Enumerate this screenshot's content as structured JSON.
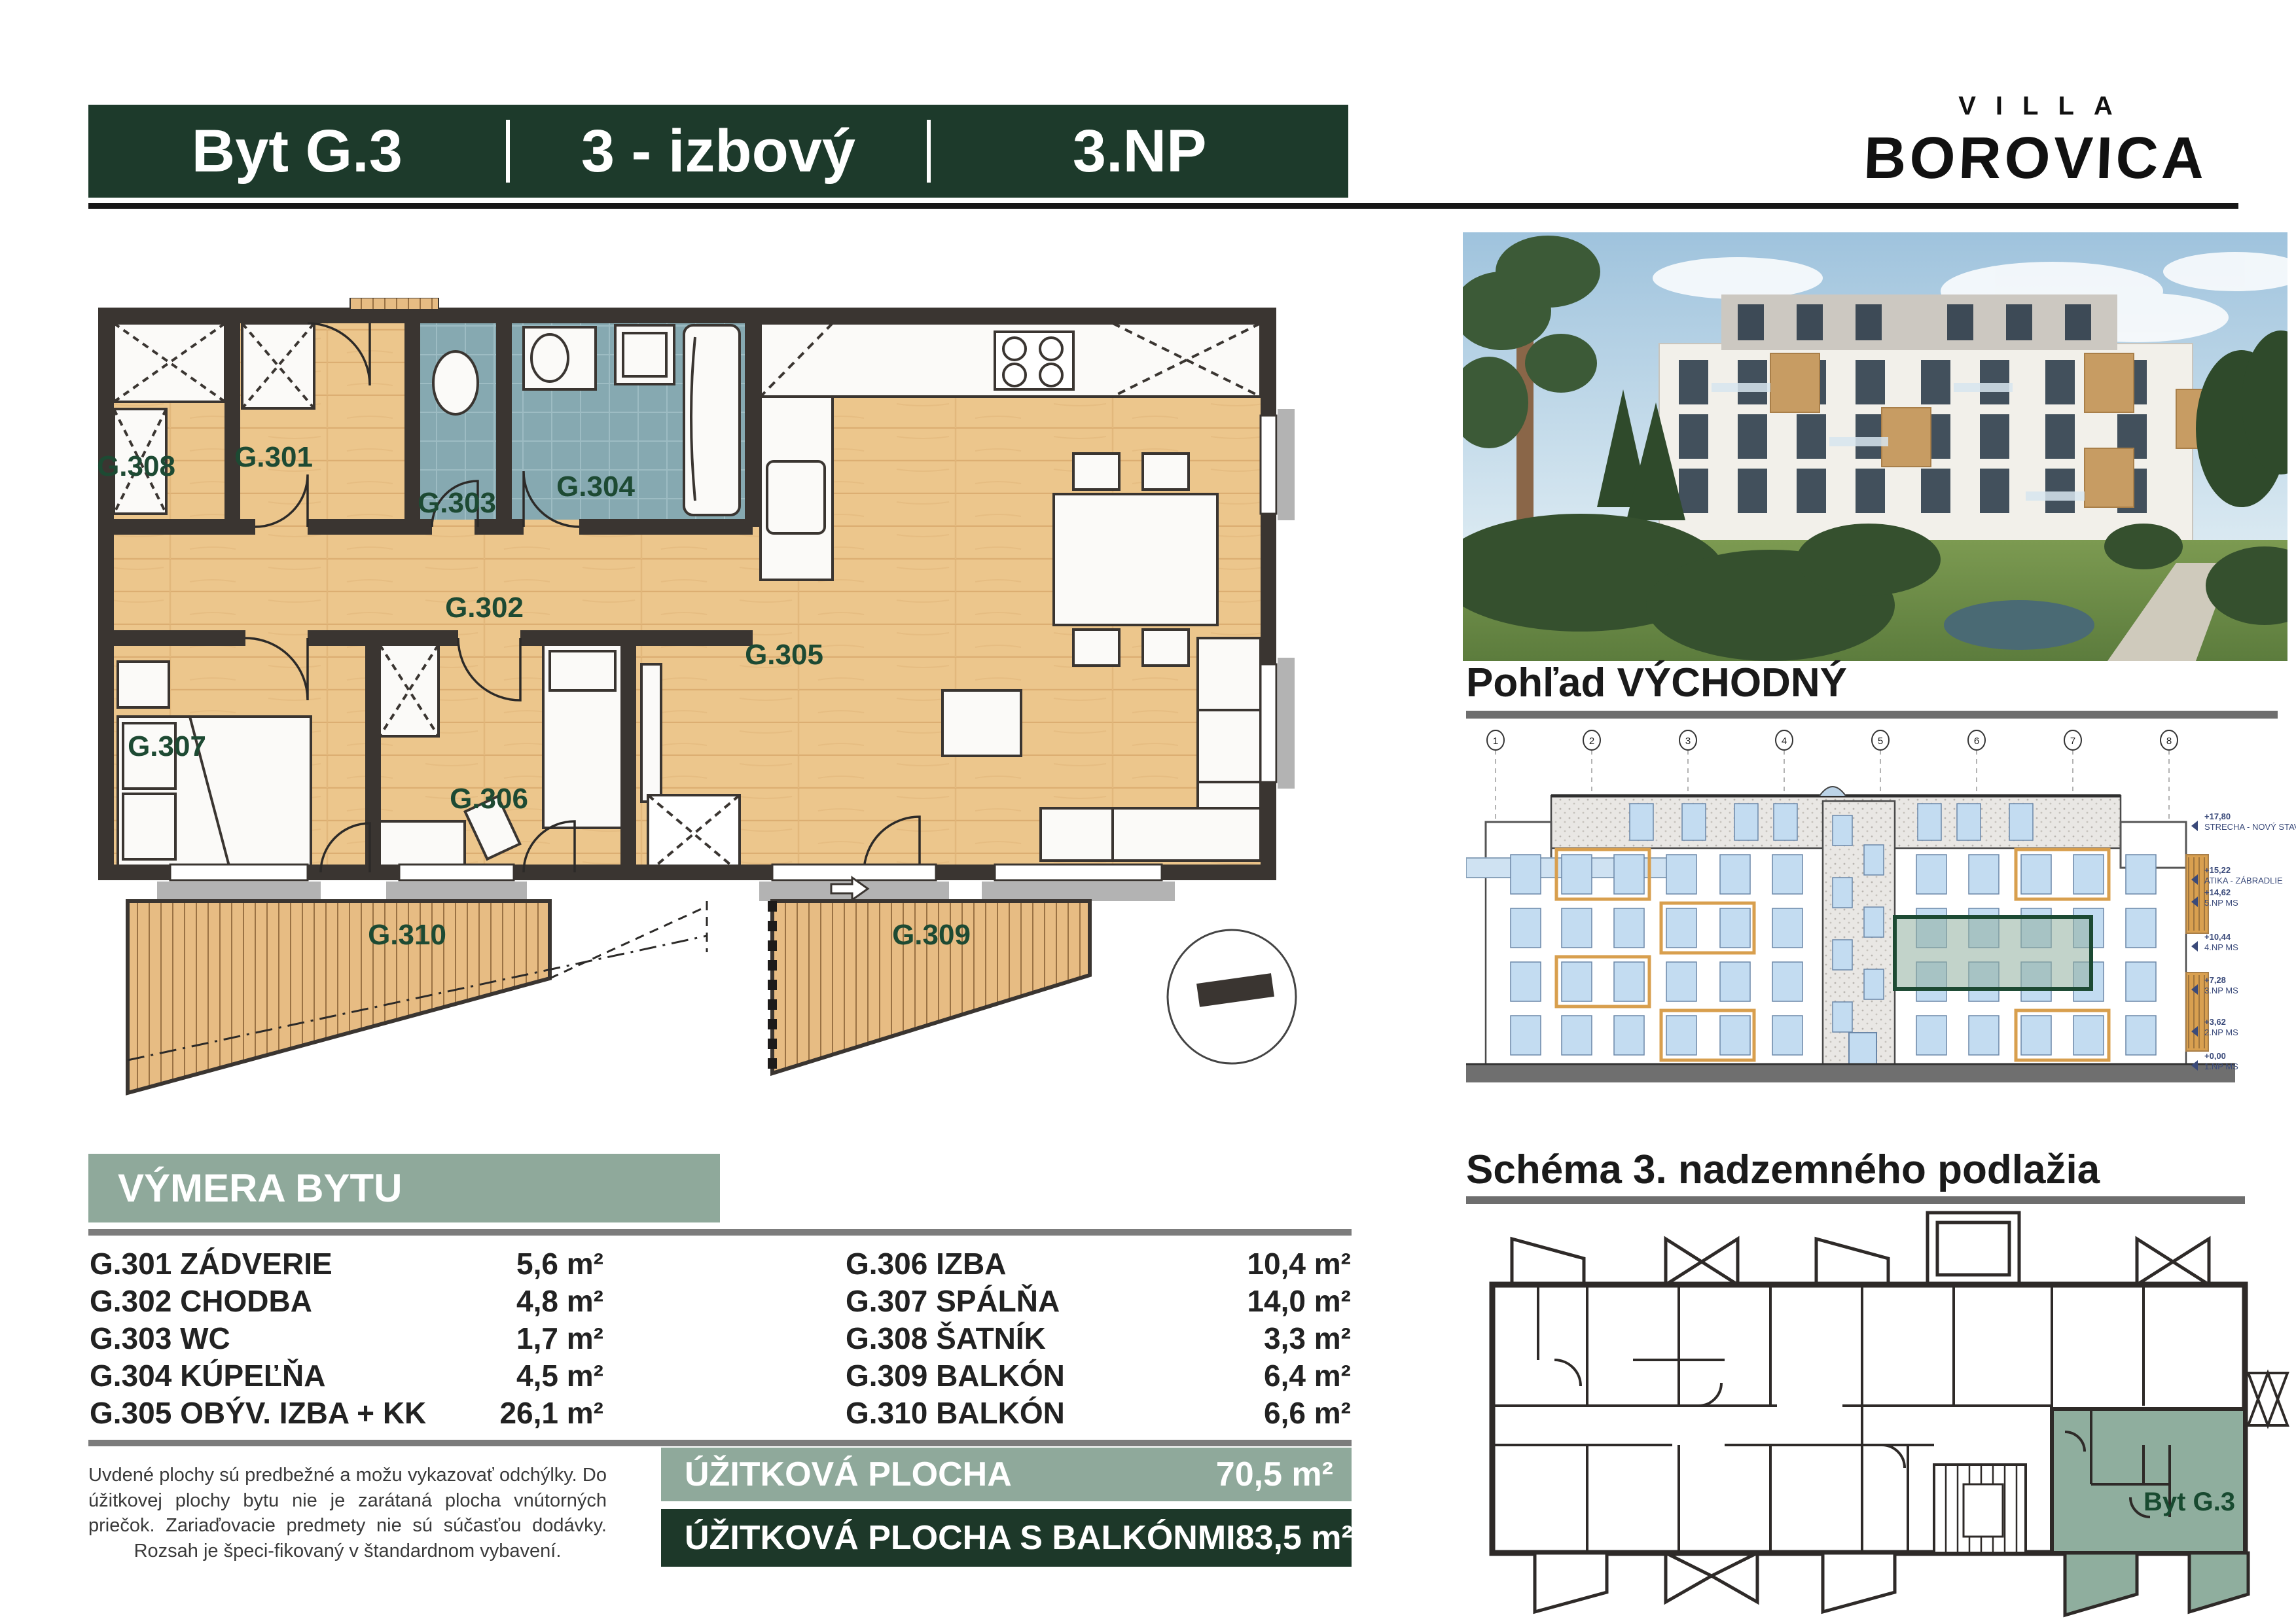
{
  "header": {
    "unit": "Byt G.3",
    "type": "3 - izbový",
    "floor": "3.NP"
  },
  "brand": {
    "line1": "VILLA",
    "line2": "BOROVICA"
  },
  "sections": {
    "east_view_title": "Pohľad VÝCHODNÝ",
    "schema_title": "Schéma 3. nadzemného podlažia",
    "schema_highlight_label": "Byt G.3"
  },
  "floorplan": {
    "rooms": [
      {
        "id": "G.301"
      },
      {
        "id": "G.302"
      },
      {
        "id": "G.303"
      },
      {
        "id": "G.304"
      },
      {
        "id": "G.305"
      },
      {
        "id": "G.306"
      },
      {
        "id": "G.307"
      },
      {
        "id": "G.308"
      },
      {
        "id": "G.309"
      },
      {
        "id": "G.310"
      }
    ]
  },
  "elevation": {
    "axes": [
      "1",
      "2",
      "3",
      "4",
      "5",
      "6",
      "7",
      "8"
    ],
    "levels": [
      {
        "value": "+17,80",
        "label": "STRECHA - NOVÝ STAV"
      },
      {
        "value": "+15,22",
        "label": "ATIKA - ZÁBRADLIE"
      },
      {
        "value": "+14,62",
        "label": "5.NP MS"
      },
      {
        "value": "+10,44",
        "label": "4.NP MS"
      },
      {
        "value": "+7,28",
        "label": "3.NP MS"
      },
      {
        "value": "+3,62",
        "label": "2.NP MS"
      },
      {
        "value": "+0,00",
        "label": "1.NP MS"
      }
    ]
  },
  "area_table": {
    "title": "VÝMERA BYTU",
    "left": [
      {
        "label": "G.301 ZÁDVERIE",
        "area": "5,6 m²"
      },
      {
        "label": "G.302 CHODBA",
        "area": "4,8 m²"
      },
      {
        "label": "G.303 WC",
        "area": "1,7 m²"
      },
      {
        "label": "G.304 KÚPEĽŇA",
        "area": "4,5 m²"
      },
      {
        "label": "G.305 OBÝV. IZBA + KK",
        "area": "26,1 m²"
      }
    ],
    "right": [
      {
        "label": "G.306 IZBA",
        "area": "10,4 m²"
      },
      {
        "label": "G.307 SPÁLŇA",
        "area": "14,0 m²"
      },
      {
        "label": "G.308 ŠATNÍK",
        "area": "3,3 m²"
      },
      {
        "label": "G.309 BALKÓN",
        "area": "6,4 m²"
      },
      {
        "label": "G.310 BALKÓN",
        "area": "6,6 m²"
      }
    ]
  },
  "totals": [
    {
      "label": "ÚŽITKOVÁ PLOCHA",
      "value": "70,5 m²"
    },
    {
      "label": "ÚŽITKOVÁ PLOCHA  S BALKÓNMI",
      "value": "83,5 m²"
    }
  ],
  "disclaimer": "Uvdené plochy sú predbežné a možu vykazovať odchýlky. Do úžitkovej plochy bytu nie je zarátaná plocha vnútorných priečok. Zariaďovacie predmety nie sú súčasťou dodávky. Rozsah je špeci-fikovaný v štandardnom vybavení.",
  "colors": {
    "header_green": "#1d3a2b",
    "sage": "#8fa99b",
    "dark_bar_green": "#1d3829",
    "room_label_green": "#1d4a33",
    "wall": "#3a3531",
    "wood_floor": "#ecc68c",
    "bath_tile": "#86a9b1",
    "window_blue": "#c3dcf1",
    "highlight": "#8fae9e",
    "annotation_navy": "#3a4a7a"
  }
}
